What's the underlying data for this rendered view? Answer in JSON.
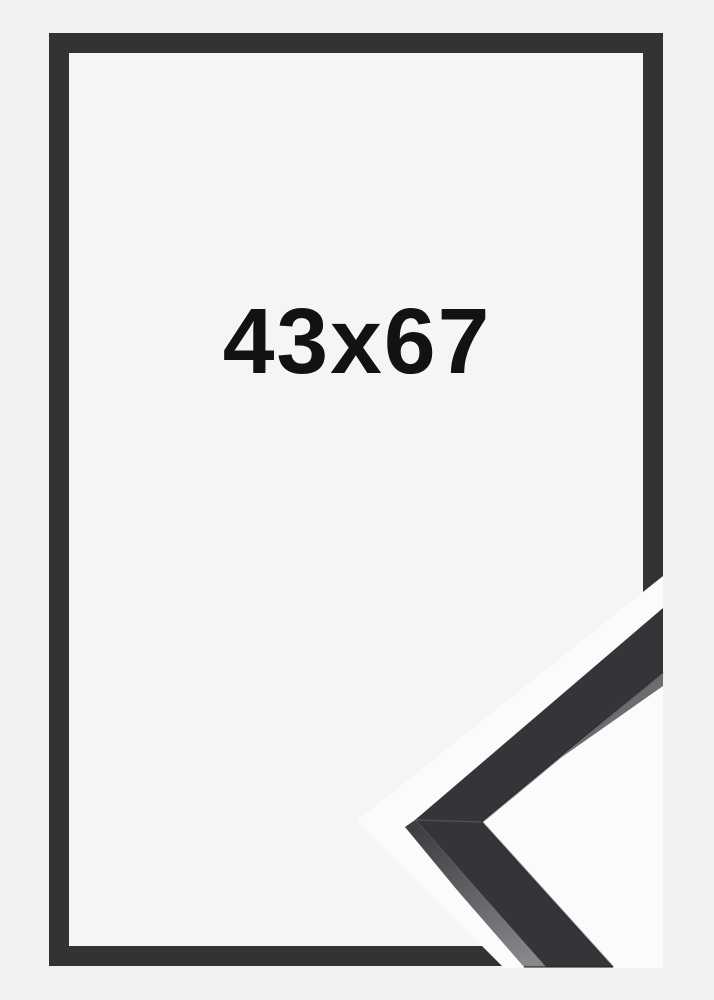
{
  "product": {
    "size_label": "43x67"
  },
  "scene": {
    "description_elements": {
      "front_view": "picture-frame-front-view",
      "corner_detail": "frame-moulding-corner-closeup"
    }
  },
  "colors": {
    "page_background": "#f1f1f2",
    "frame_interior_background": "#f5f5f6",
    "frame_border": "#313335",
    "detail_background": "#fbfbfc",
    "detail_face": "#333538",
    "detail_side_dark": "#3e3f42",
    "detail_side_mid": "#6b6d70",
    "detail_side_light": "#85878a",
    "detail_seam": "#515355",
    "detail_edge_shadow": "#1e1f20",
    "label_text": "#121212"
  }
}
